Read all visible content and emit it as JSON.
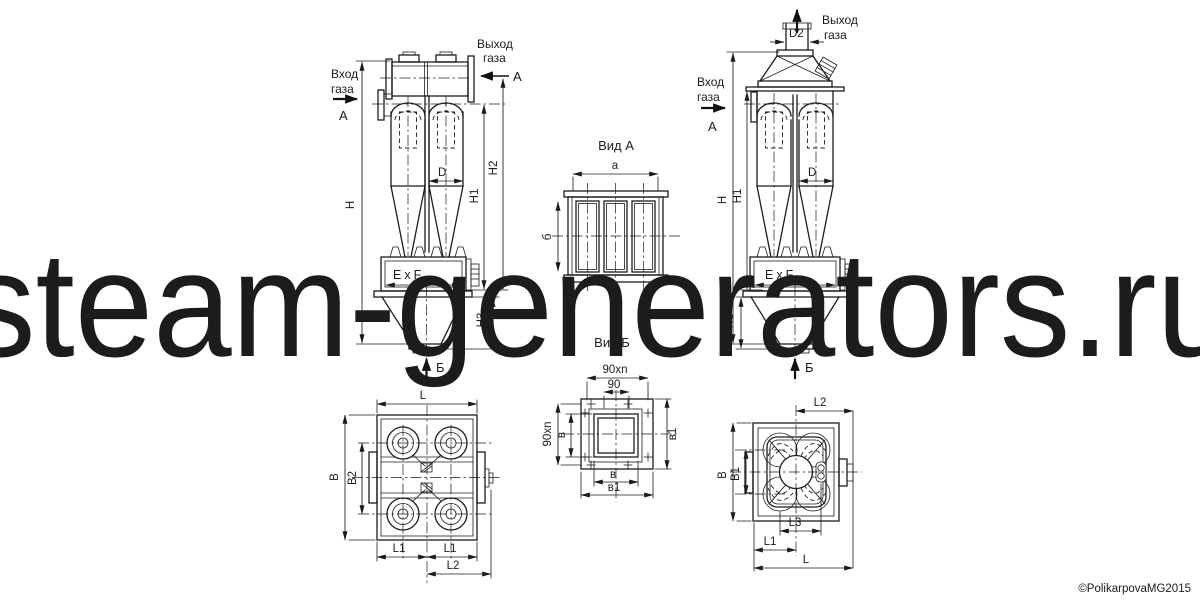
{
  "watermark": {
    "text": "steam-generators.ru",
    "color": "#a9a9a9"
  },
  "copyright": {
    "text": "©PolikarpovaMG2015",
    "color": "#bcbcbc"
  },
  "colors": {
    "line": "#1c1c1c",
    "background": "#ffffff"
  },
  "left_elevation": {
    "inlet1": "Вход",
    "inlet2": "газа",
    "inlet_section": "А",
    "outlet1": "Выход",
    "outlet2": "газа",
    "outlet_section": "А",
    "h": "H",
    "h1": "H1",
    "h2": "H2",
    "h3": "H3",
    "d": "D",
    "bunker": "ExF",
    "bottom_section": "Б"
  },
  "right_elevation": {
    "inlet1": "Вход",
    "inlet2": "газа",
    "inlet_section": "А",
    "outlet1": "Выход",
    "outlet2": "газа",
    "d2": "D2",
    "h": "H",
    "h1": "H1",
    "h3": "H3",
    "d": "D",
    "bunker": "ExF",
    "bottom_section": "Б"
  },
  "view_a": {
    "title": "Вид А",
    "width": "а",
    "height": "б"
  },
  "view_b": {
    "title": "Вид Б",
    "pitch_row": "90xn",
    "pitch": "90",
    "pitch_col": "90xn",
    "v": "в",
    "v1": "в1",
    "v_bottom": "в",
    "v1_bottom": "в1"
  },
  "plan_left": {
    "l": "L",
    "b": "B",
    "b2": "B2",
    "l1a": "L1",
    "l1b": "L1",
    "l2": "L2"
  },
  "plan_right": {
    "l2": "L2",
    "b": "B",
    "b1": "B1",
    "l3": "L3",
    "l1": "L1",
    "l": "L"
  }
}
